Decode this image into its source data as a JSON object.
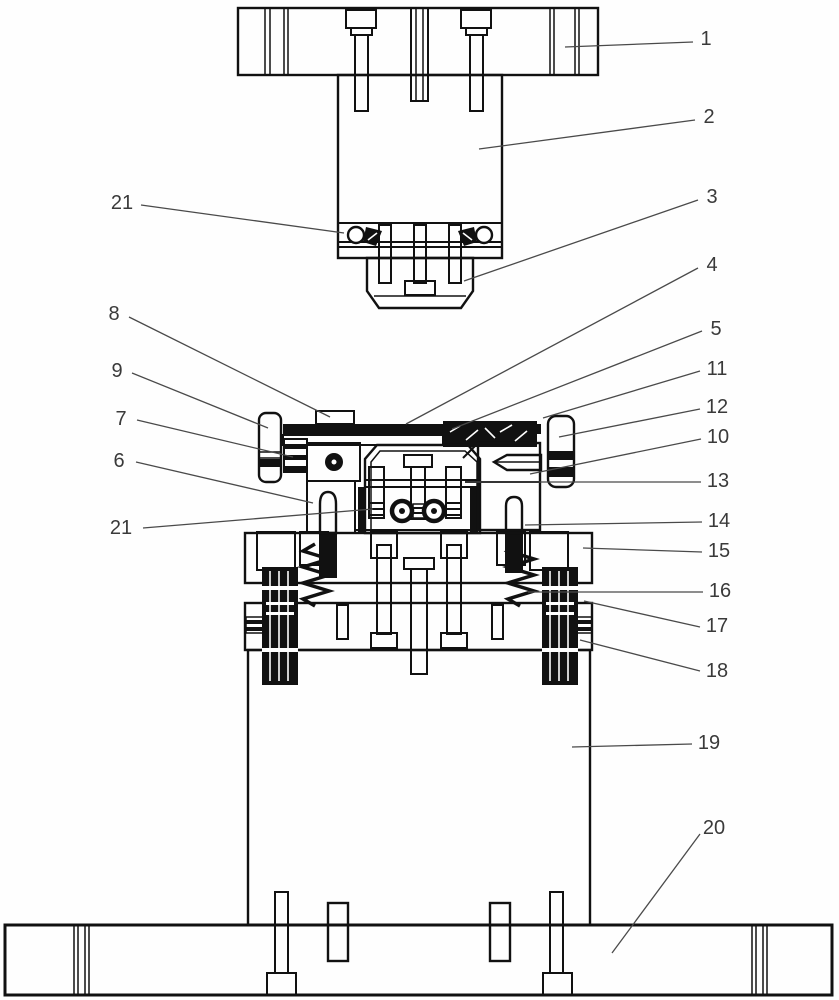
{
  "figure": {
    "kind": "patent-die-assembly-drawing",
    "background": "#fefefe",
    "line_color": "#111111",
    "leader_color": "#4a4a4a",
    "label_color": "#3a3a3a",
    "label_font_px": 20
  },
  "labels": [
    {
      "text": "1",
      "tx": 706,
      "ty": 39,
      "x1": 693,
      "y1": 42,
      "x2": 565,
      "y2": 47
    },
    {
      "text": "2",
      "tx": 709,
      "ty": 117,
      "x1": 695,
      "y1": 120,
      "x2": 479,
      "y2": 149
    },
    {
      "text": "3",
      "tx": 712,
      "ty": 197,
      "x1": 698,
      "y1": 200,
      "x2": 464,
      "y2": 281
    },
    {
      "text": "4",
      "tx": 712,
      "ty": 265,
      "x1": 698,
      "y1": 268,
      "x2": 406,
      "y2": 424
    },
    {
      "text": "5",
      "tx": 716,
      "ty": 329,
      "x1": 702,
      "y1": 331,
      "x2": 452,
      "y2": 429
    },
    {
      "text": "11",
      "tx": 717,
      "ty": 369,
      "x1": 700,
      "y1": 371,
      "x2": 543,
      "y2": 418
    },
    {
      "text": "12",
      "tx": 717,
      "ty": 407,
      "x1": 700,
      "y1": 409,
      "x2": 559,
      "y2": 437
    },
    {
      "text": "10",
      "tx": 718,
      "ty": 437,
      "x1": 701,
      "y1": 439,
      "x2": 530,
      "y2": 474
    },
    {
      "text": "13",
      "tx": 718,
      "ty": 481,
      "x1": 701,
      "y1": 482,
      "x2": 465,
      "y2": 482
    },
    {
      "text": "14",
      "tx": 719,
      "ty": 521,
      "x1": 702,
      "y1": 522,
      "x2": 525,
      "y2": 525
    },
    {
      "text": "15",
      "tx": 719,
      "ty": 551,
      "x1": 702,
      "y1": 552,
      "x2": 583,
      "y2": 548
    },
    {
      "text": "16",
      "tx": 720,
      "ty": 591,
      "x1": 703,
      "y1": 592,
      "x2": 528,
      "y2": 592
    },
    {
      "text": "17",
      "tx": 717,
      "ty": 626,
      "x1": 700,
      "y1": 627,
      "x2": 584,
      "y2": 601
    },
    {
      "text": "18",
      "tx": 717,
      "ty": 671,
      "x1": 700,
      "y1": 671,
      "x2": 580,
      "y2": 640
    },
    {
      "text": "19",
      "tx": 709,
      "ty": 743,
      "x1": 692,
      "y1": 744,
      "x2": 572,
      "y2": 747
    },
    {
      "text": "20",
      "tx": 714,
      "ty": 828,
      "x1": 700,
      "y1": 834,
      "x2": 612,
      "y2": 953
    },
    {
      "text": "21",
      "tx": 122,
      "ty": 203,
      "x1": 141,
      "y1": 205,
      "x2": 344,
      "y2": 233
    },
    {
      "text": "8",
      "tx": 114,
      "ty": 314,
      "x1": 129,
      "y1": 317,
      "x2": 330,
      "y2": 417
    },
    {
      "text": "9",
      "tx": 117,
      "ty": 371,
      "x1": 132,
      "y1": 373,
      "x2": 268,
      "y2": 428
    },
    {
      "text": "7",
      "tx": 121,
      "ty": 419,
      "x1": 137,
      "y1": 420,
      "x2": 293,
      "y2": 457
    },
    {
      "text": "6",
      "tx": 119,
      "ty": 461,
      "x1": 136,
      "y1": 462,
      "x2": 313,
      "y2": 503
    },
    {
      "text": "21",
      "tx": 121,
      "ty": 528,
      "x1": 143,
      "y1": 528,
      "x2": 373,
      "y2": 509
    }
  ]
}
